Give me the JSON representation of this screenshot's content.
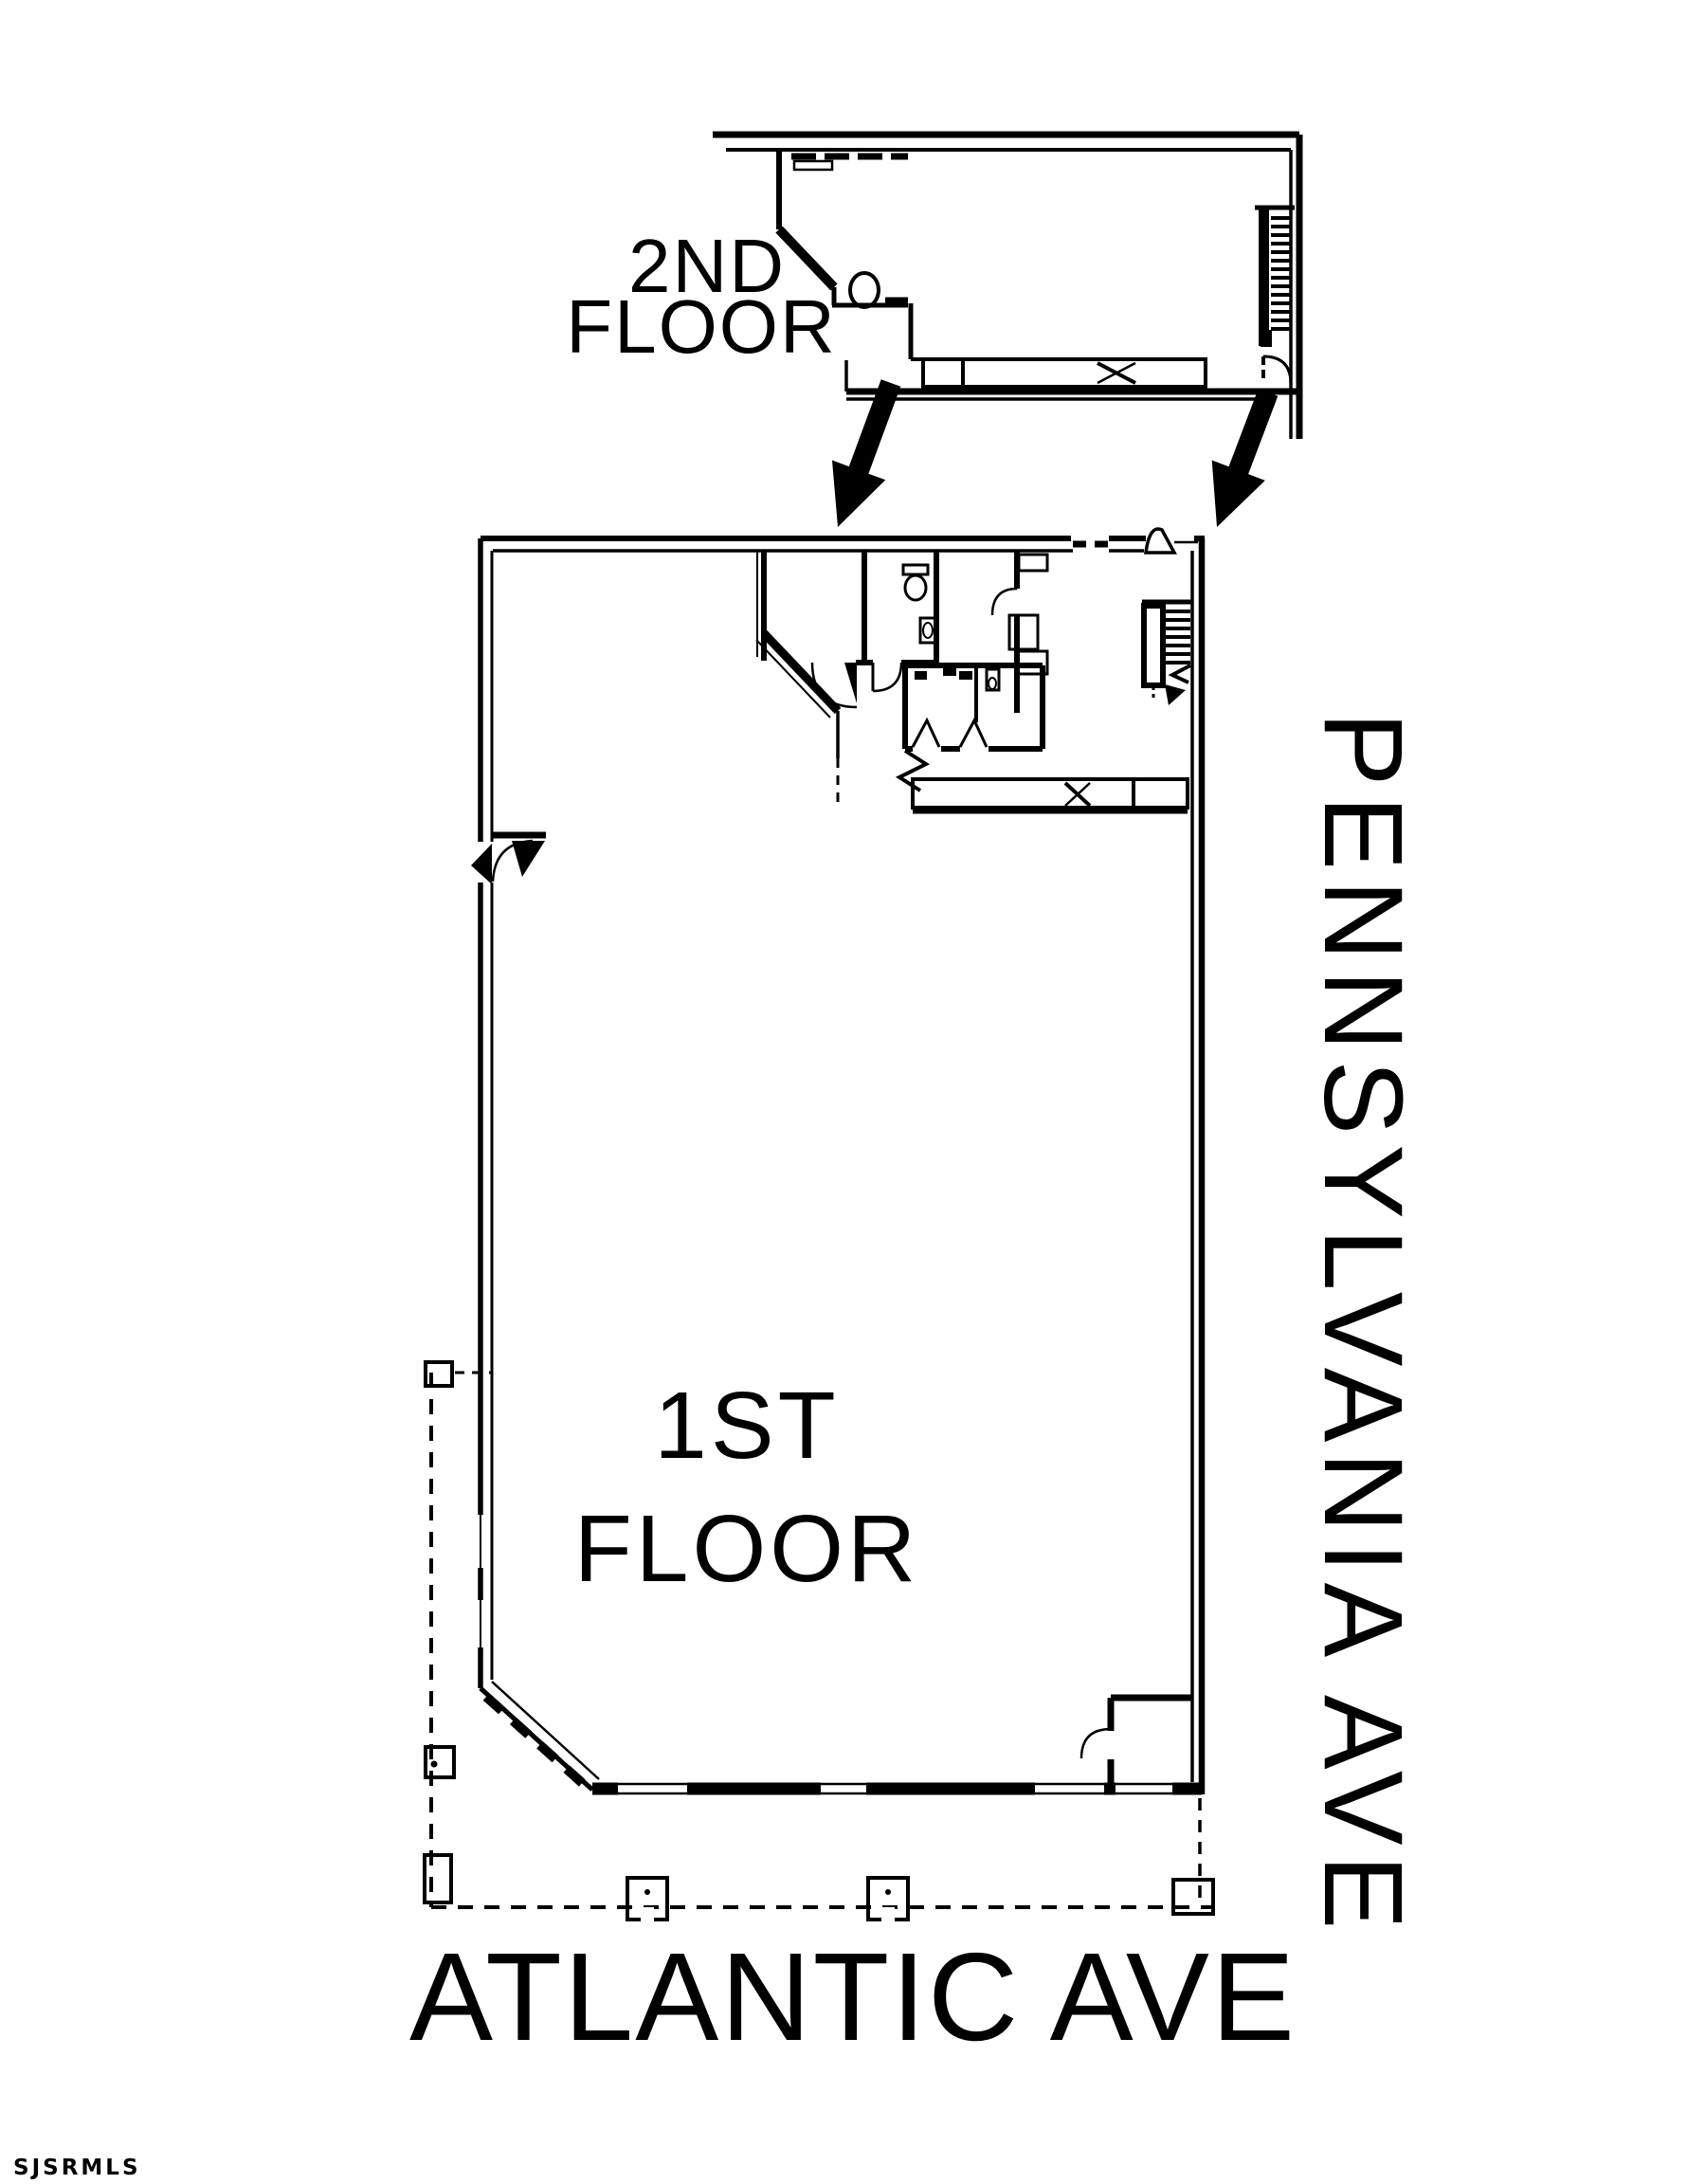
{
  "colors": {
    "ink": "#000000",
    "paper": "#ffffff"
  },
  "labels": {
    "second_floor_line1": "2ND",
    "second_floor_line2": "FLOOR",
    "first_floor_line1": "1ST",
    "first_floor_line2": "FLOOR",
    "street_right": "PENNSYLVANIA AVE",
    "street_bottom": "ATLANTIC AVE",
    "watermark": "SJSRMLS"
  },
  "plan": {
    "type": "floor-plan",
    "levels": [
      {
        "name": "2nd Floor"
      },
      {
        "name": "1st Floor"
      }
    ],
    "streets": [
      {
        "name": "PENNSYLVANIA AVE",
        "side": "right"
      },
      {
        "name": "ATLANTIC AVE",
        "side": "bottom"
      }
    ]
  }
}
